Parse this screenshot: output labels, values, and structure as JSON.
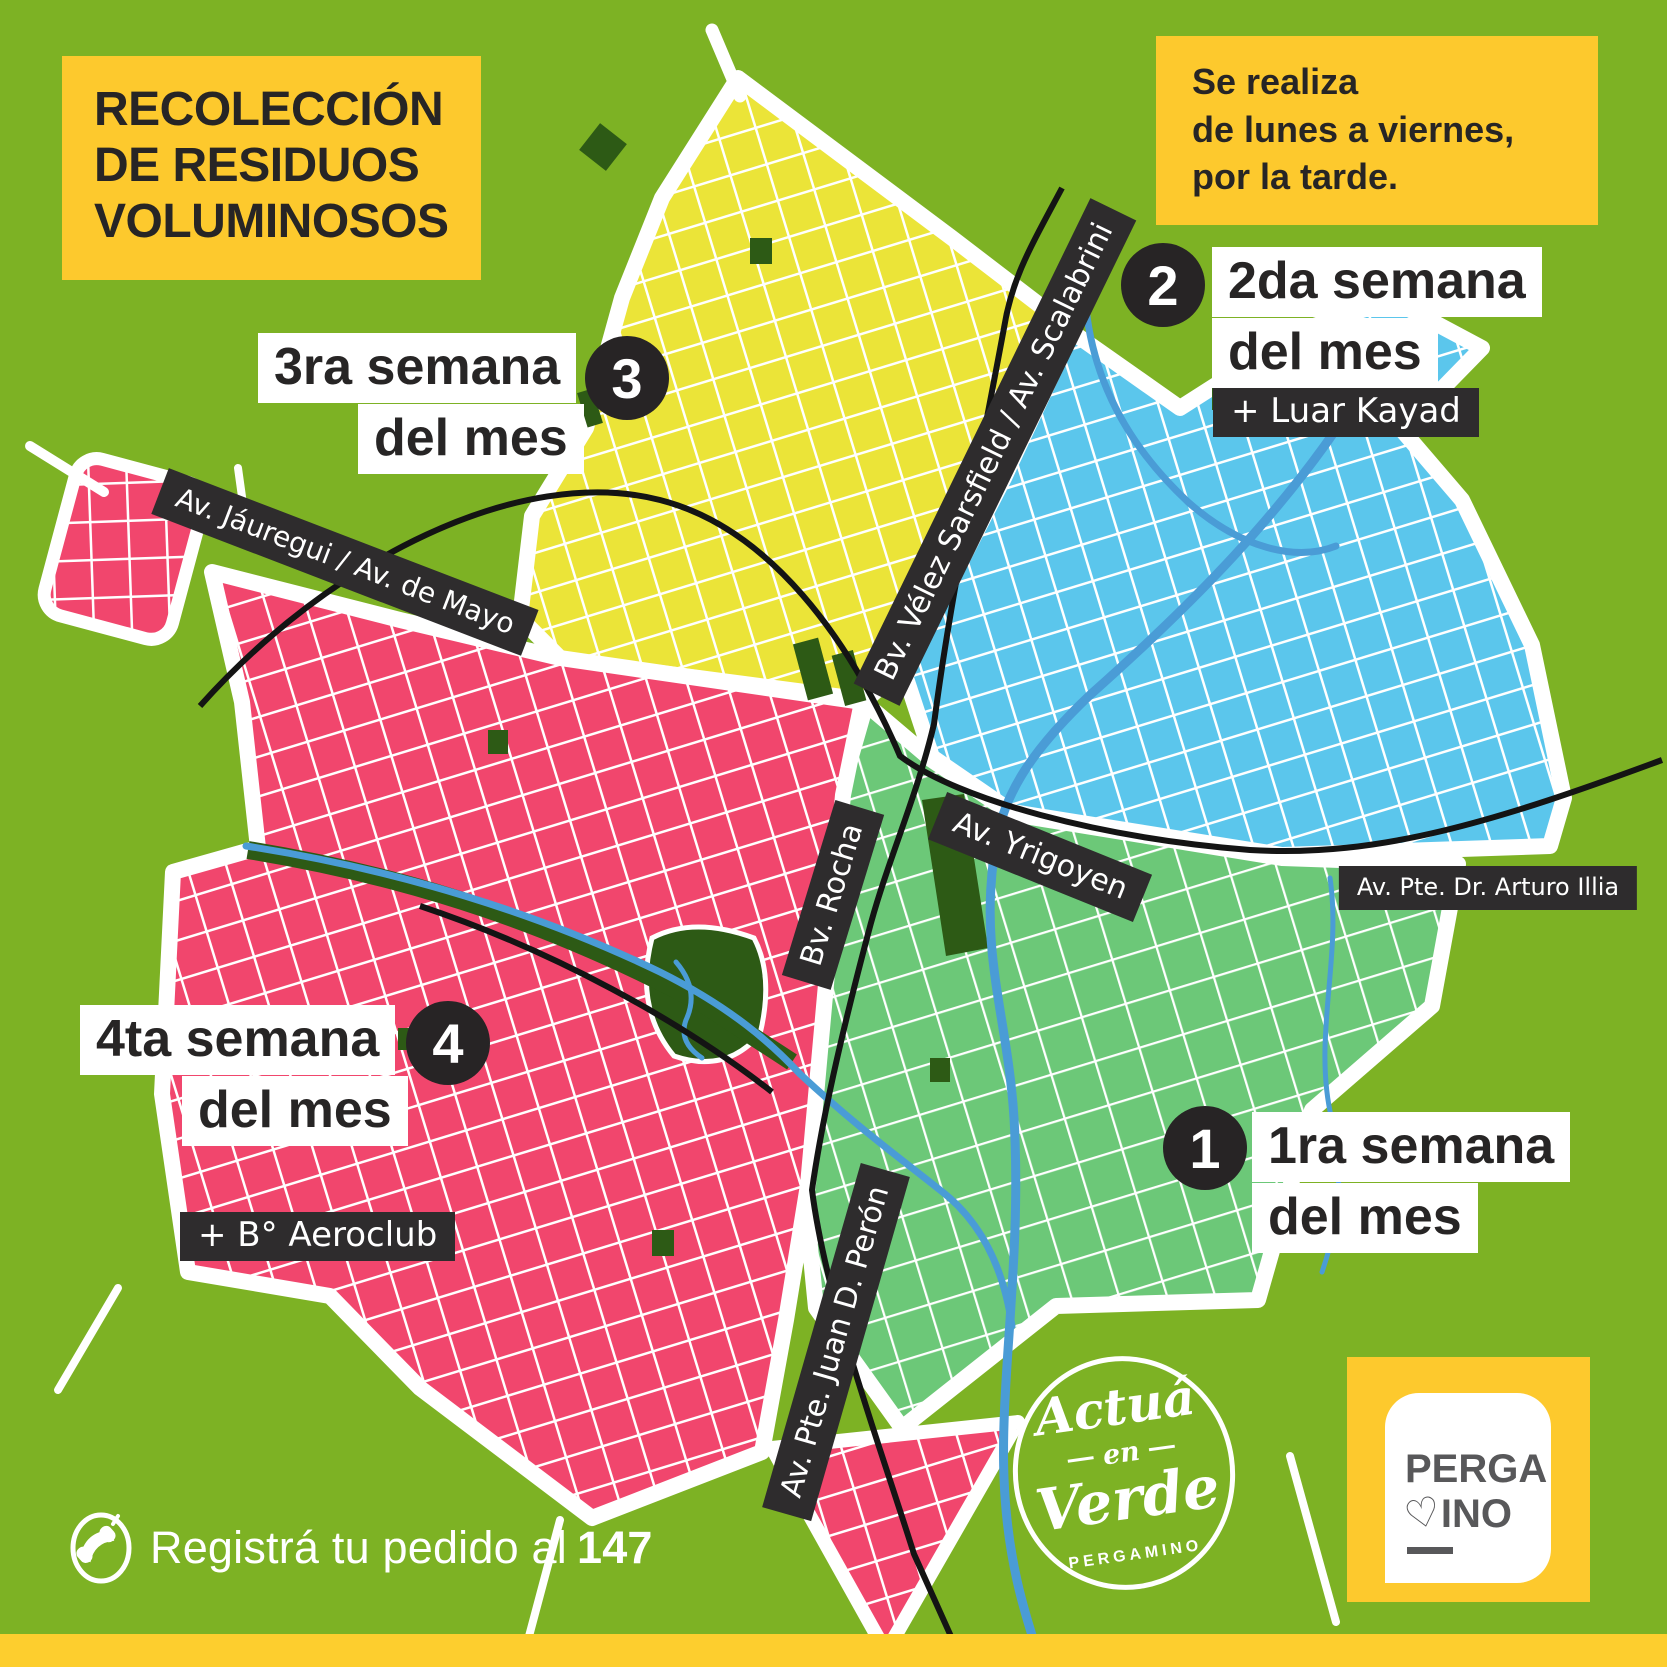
{
  "title": {
    "lines": [
      "RECOLECCIÓN",
      "DE RESIDUOS",
      "VOLUMINOSOS"
    ]
  },
  "schedule": {
    "lines": [
      "Se realiza",
      "de lunes a viernes,",
      "por la tarde."
    ]
  },
  "zones": [
    {
      "number": "1",
      "line1": "1ra semana",
      "line2": "del mes",
      "extra": "",
      "color": "#6cc878"
    },
    {
      "number": "2",
      "line1": "2da semana",
      "line2": "del mes",
      "extra": "+ Luar Kayad",
      "color": "#5bc6ec"
    },
    {
      "number": "3",
      "line1": "3ra semana",
      "line2": "del mes",
      "extra": "",
      "color": "#ebe438"
    },
    {
      "number": "4",
      "line1": "4ta semana",
      "line2": "del mes",
      "extra": "+ B° Aeroclub",
      "color": "#f1466d"
    }
  ],
  "streets": {
    "jauregui": "Av. Jáuregui / Av. de Mayo",
    "sarsfield": "Bv. Vélez Sarsfield / Av. Scalabrini",
    "rocha": "Bv. Rocha",
    "yrigoyen": "Av. Yrigoyen",
    "illia": "Av. Pte. Dr. Arturo Illia",
    "peron": "Av. Pte. Juan D. Perón"
  },
  "footer": {
    "prefix": "Registrá tu pedido al",
    "number": "147"
  },
  "stamp": {
    "word1": "Actuá",
    "word2": "en",
    "word3": "Verde",
    "sub": "PERGAMINO"
  },
  "logo": {
    "top": "PERGA",
    "heart": "♡",
    "rest": "INO"
  },
  "colors": {
    "background": "#7db224",
    "zone_yellow": "#ebe438",
    "zone_blue": "#5bc6ec",
    "zone_pink": "#f1466d",
    "zone_green": "#6cc878",
    "park_green": "#2d5a15",
    "river_blue": "#4a9cd6",
    "accent_yellow": "#fdc92d",
    "label_dark": "#2e2c2d",
    "text_dark": "#272525"
  }
}
